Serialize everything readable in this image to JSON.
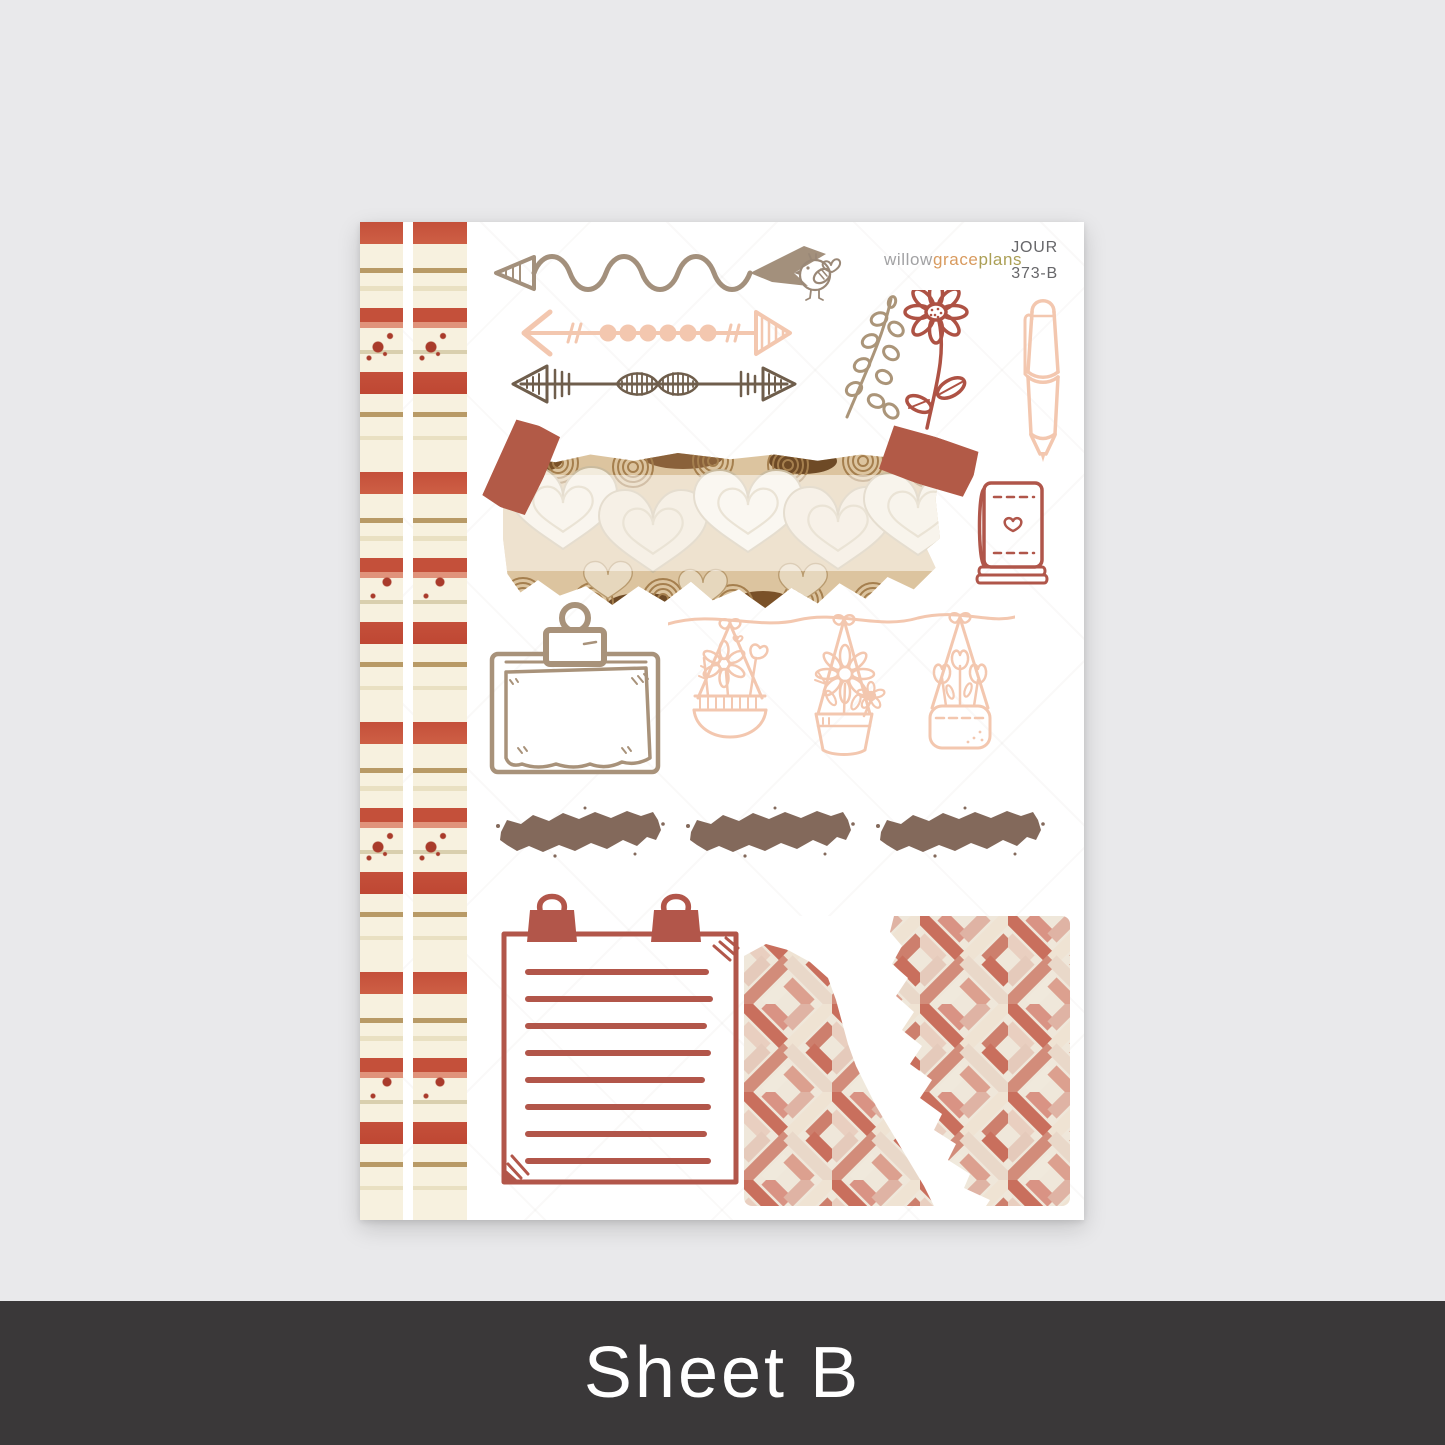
{
  "page": {
    "background": "#e9e9eb"
  },
  "brand": {
    "willow": "willow",
    "grace": "grace",
    "plans": "plans"
  },
  "sheet_code": {
    "line1": "JOUR",
    "line2": "373-B"
  },
  "footer": {
    "label": "Sheet B",
    "background": "#3a3839",
    "text_color": "#ffffff"
  },
  "palette": {
    "washi_red": "#c4503a",
    "washi_cream": "#f7f1df",
    "washi_gold": "#b89a66",
    "rust": "#b2564a",
    "tape_terracotta": "#b25a47",
    "peach": "#f3c7af",
    "tan": "#a8927a",
    "brush_brown": "#83695b",
    "dark_arrow": "#6f5e4c"
  },
  "stickers": [
    "striped-washi-strip-left",
    "striped-washi-strip-right",
    "wavy-arrow",
    "bird-doodle",
    "dotted-arrow",
    "tribal-arrow",
    "eucalyptus-branch",
    "daisy-flower",
    "pen",
    "heart-wood-washi-with-tape",
    "heart-journal-book",
    "clipboard",
    "hanging-flower-baskets",
    "brush-stroke-1",
    "brush-stroke-2",
    "brush-stroke-3",
    "clipped-notepad",
    "herringbone-torn-paper"
  ]
}
